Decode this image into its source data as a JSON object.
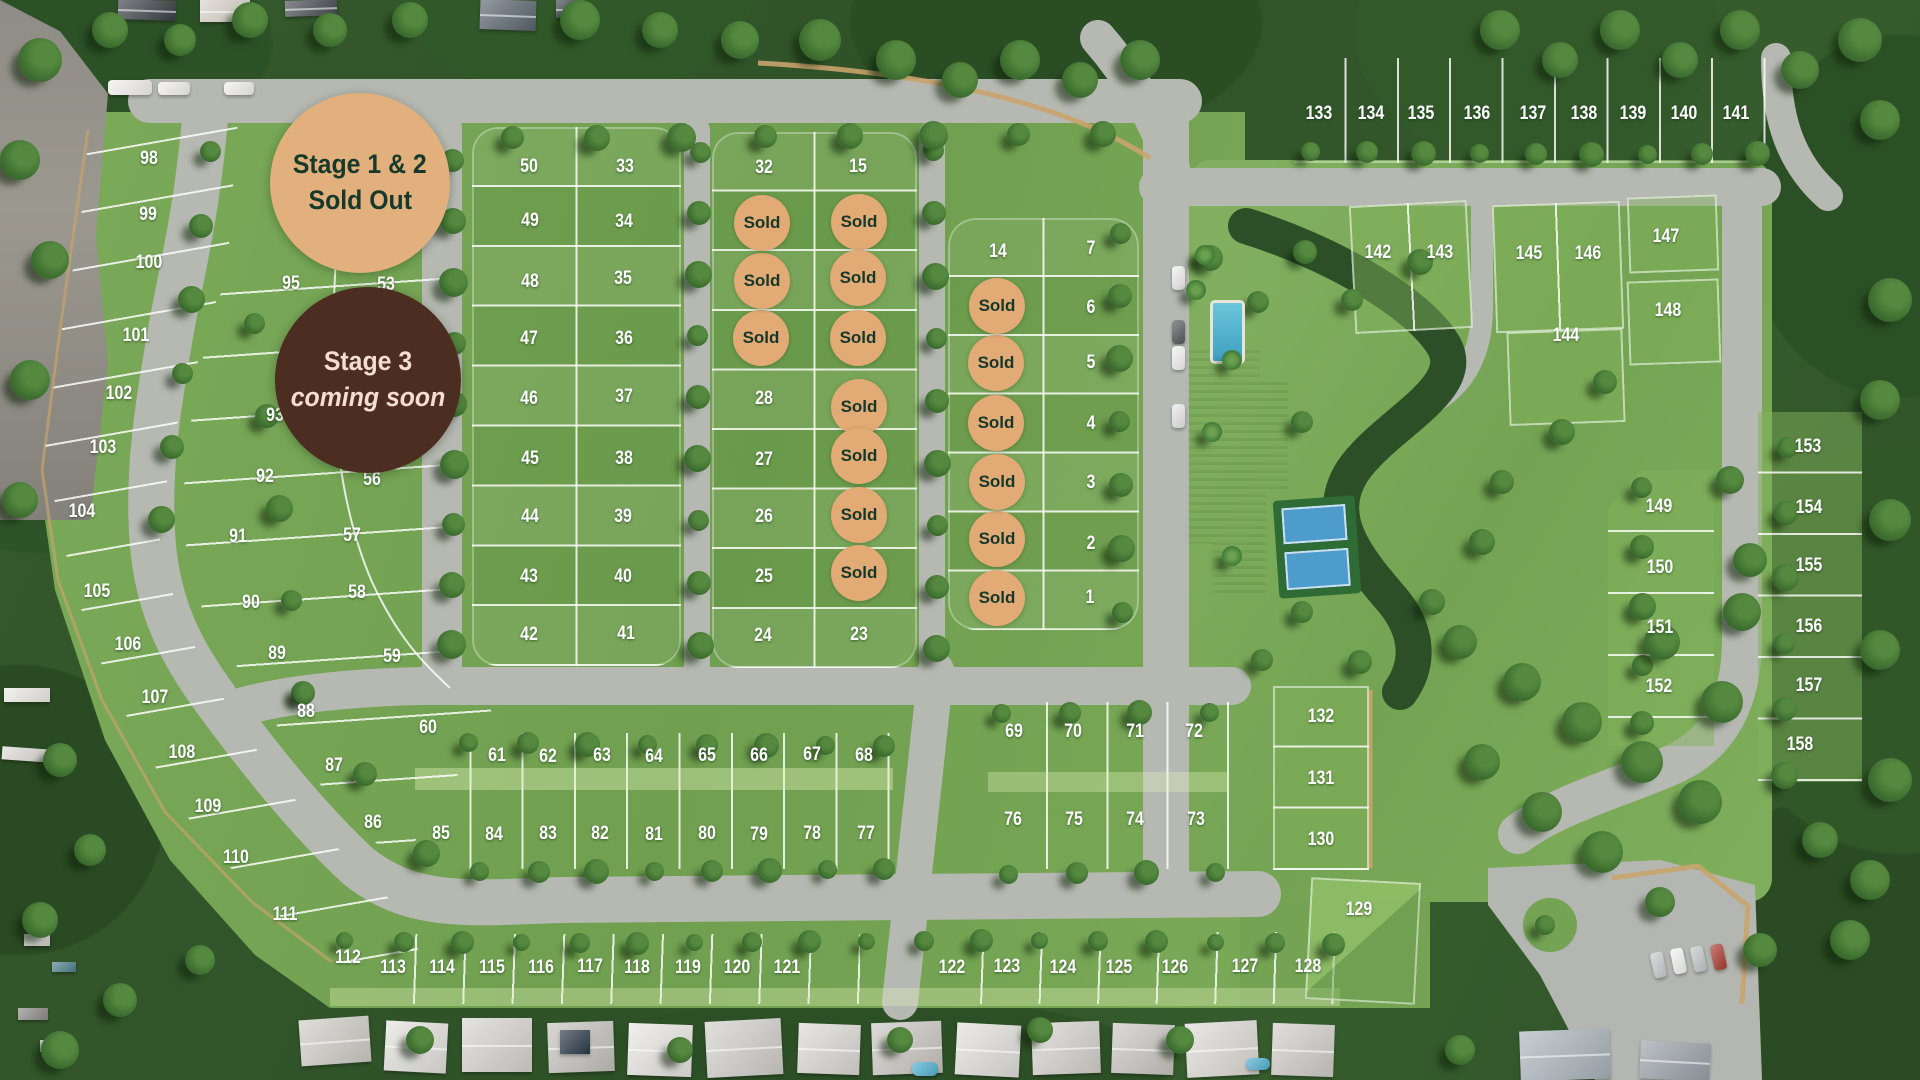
{
  "stage_badges": [
    {
      "id": "stage-1-2",
      "line1": "Stage 1 & 2",
      "line2": "Sold Out",
      "x": 360,
      "y": 183,
      "r": 90,
      "bg": "#e2b07d",
      "fg": "#17392b",
      "italic2": false
    },
    {
      "id": "stage-3",
      "line1": "Stage 3",
      "line2": "coming soon",
      "x": 368,
      "y": 380,
      "r": 93,
      "bg": "#4b2d21",
      "fg": "#f5ddd0",
      "italic2": true
    }
  ],
  "sold_label": "Sold",
  "colors": {
    "sold_bg": "#e2aa74",
    "sold_fg": "#15382b",
    "lot_text": "#ffffff",
    "road": "#b6b9b2",
    "lawn": "#74a354"
  },
  "lots": [
    {
      "n": 1,
      "x": 1090,
      "y": 598
    },
    {
      "n": 2,
      "x": 1091,
      "y": 544
    },
    {
      "n": 3,
      "x": 1091,
      "y": 483
    },
    {
      "n": 4,
      "x": 1091,
      "y": 424
    },
    {
      "n": 5,
      "x": 1091,
      "y": 363
    },
    {
      "n": 6,
      "x": 1091,
      "y": 308
    },
    {
      "n": 7,
      "x": 1091,
      "y": 249
    },
    {
      "n": 8,
      "x": 997,
      "y": 598,
      "sold": true
    },
    {
      "n": 9,
      "x": 997,
      "y": 539,
      "sold": true
    },
    {
      "n": 10,
      "x": 997,
      "y": 482,
      "sold": true
    },
    {
      "n": 11,
      "x": 996,
      "y": 423,
      "sold": true
    },
    {
      "n": 12,
      "x": 996,
      "y": 363,
      "sold": true
    },
    {
      "n": 13,
      "x": 997,
      "y": 306,
      "sold": true
    },
    {
      "n": 14,
      "x": 998,
      "y": 252
    },
    {
      "n": 15,
      "x": 858,
      "y": 167
    },
    {
      "n": 16,
      "x": 859,
      "y": 222,
      "sold": true
    },
    {
      "n": 17,
      "x": 858,
      "y": 278,
      "sold": true
    },
    {
      "n": 18,
      "x": 858,
      "y": 338,
      "sold": true
    },
    {
      "n": 19,
      "x": 859,
      "y": 407,
      "sold": true
    },
    {
      "n": 20,
      "x": 859,
      "y": 456,
      "sold": true
    },
    {
      "n": 21,
      "x": 859,
      "y": 515,
      "sold": true
    },
    {
      "n": 22,
      "x": 859,
      "y": 573,
      "sold": true
    },
    {
      "n": 23,
      "x": 859,
      "y": 635
    },
    {
      "n": 24,
      "x": 763,
      "y": 636
    },
    {
      "n": 25,
      "x": 764,
      "y": 577
    },
    {
      "n": 26,
      "x": 764,
      "y": 517
    },
    {
      "n": 27,
      "x": 764,
      "y": 460
    },
    {
      "n": 28,
      "x": 764,
      "y": 399
    },
    {
      "n": 29,
      "x": 761,
      "y": 338,
      "sold": true
    },
    {
      "n": 30,
      "x": 762,
      "y": 281,
      "sold": true
    },
    {
      "n": 31,
      "x": 762,
      "y": 223,
      "sold": true
    },
    {
      "n": 32,
      "x": 764,
      "y": 168
    },
    {
      "n": 33,
      "x": 625,
      "y": 167
    },
    {
      "n": 34,
      "x": 624,
      "y": 222
    },
    {
      "n": 35,
      "x": 623,
      "y": 279
    },
    {
      "n": 36,
      "x": 624,
      "y": 339
    },
    {
      "n": 37,
      "x": 624,
      "y": 397
    },
    {
      "n": 38,
      "x": 624,
      "y": 459
    },
    {
      "n": 39,
      "x": 623,
      "y": 517
    },
    {
      "n": 40,
      "x": 623,
      "y": 577
    },
    {
      "n": 41,
      "x": 626,
      "y": 634
    },
    {
      "n": 42,
      "x": 529,
      "y": 635
    },
    {
      "n": 43,
      "x": 529,
      "y": 577
    },
    {
      "n": 44,
      "x": 530,
      "y": 517
    },
    {
      "n": 45,
      "x": 530,
      "y": 459
    },
    {
      "n": 46,
      "x": 529,
      "y": 399
    },
    {
      "n": 47,
      "x": 529,
      "y": 339
    },
    {
      "n": 48,
      "x": 530,
      "y": 282
    },
    {
      "n": 49,
      "x": 530,
      "y": 221
    },
    {
      "n": 50,
      "x": 529,
      "y": 167
    },
    {
      "n": 53,
      "x": 386,
      "y": 285
    },
    {
      "n": 56,
      "x": 372,
      "y": 480
    },
    {
      "n": 57,
      "x": 352,
      "y": 536
    },
    {
      "n": 58,
      "x": 357,
      "y": 593
    },
    {
      "n": 59,
      "x": 392,
      "y": 657
    },
    {
      "n": 60,
      "x": 428,
      "y": 728
    },
    {
      "n": 61,
      "x": 497,
      "y": 756
    },
    {
      "n": 62,
      "x": 548,
      "y": 757
    },
    {
      "n": 63,
      "x": 602,
      "y": 756
    },
    {
      "n": 64,
      "x": 654,
      "y": 757
    },
    {
      "n": 65,
      "x": 707,
      "y": 756
    },
    {
      "n": 66,
      "x": 759,
      "y": 756
    },
    {
      "n": 67,
      "x": 812,
      "y": 755
    },
    {
      "n": 68,
      "x": 864,
      "y": 756
    },
    {
      "n": 69,
      "x": 1014,
      "y": 732
    },
    {
      "n": 70,
      "x": 1073,
      "y": 732
    },
    {
      "n": 71,
      "x": 1135,
      "y": 732
    },
    {
      "n": 72,
      "x": 1194,
      "y": 732
    },
    {
      "n": 73,
      "x": 1196,
      "y": 820
    },
    {
      "n": 74,
      "x": 1135,
      "y": 820
    },
    {
      "n": 75,
      "x": 1074,
      "y": 820
    },
    {
      "n": 76,
      "x": 1013,
      "y": 820
    },
    {
      "n": 77,
      "x": 866,
      "y": 834
    },
    {
      "n": 78,
      "x": 812,
      "y": 834
    },
    {
      "n": 79,
      "x": 759,
      "y": 835
    },
    {
      "n": 80,
      "x": 707,
      "y": 834
    },
    {
      "n": 81,
      "x": 654,
      "y": 835
    },
    {
      "n": 82,
      "x": 600,
      "y": 834
    },
    {
      "n": 83,
      "x": 548,
      "y": 834
    },
    {
      "n": 84,
      "x": 494,
      "y": 835
    },
    {
      "n": 85,
      "x": 441,
      "y": 834
    },
    {
      "n": 86,
      "x": 373,
      "y": 823
    },
    {
      "n": 87,
      "x": 334,
      "y": 766
    },
    {
      "n": 88,
      "x": 306,
      "y": 712
    },
    {
      "n": 89,
      "x": 277,
      "y": 654
    },
    {
      "n": 90,
      "x": 251,
      "y": 603
    },
    {
      "n": 91,
      "x": 238,
      "y": 537
    },
    {
      "n": 92,
      "x": 265,
      "y": 477
    },
    {
      "n": 93,
      "x": 275,
      "y": 416
    },
    {
      "n": 95,
      "x": 291,
      "y": 284
    },
    {
      "n": 98,
      "x": 149,
      "y": 159
    },
    {
      "n": 99,
      "x": 148,
      "y": 215
    },
    {
      "n": 100,
      "x": 149,
      "y": 263
    },
    {
      "n": 101,
      "x": 136,
      "y": 336
    },
    {
      "n": 102,
      "x": 119,
      "y": 394
    },
    {
      "n": 103,
      "x": 103,
      "y": 448
    },
    {
      "n": 104,
      "x": 82,
      "y": 512
    },
    {
      "n": 105,
      "x": 97,
      "y": 592
    },
    {
      "n": 106,
      "x": 128,
      "y": 645
    },
    {
      "n": 107,
      "x": 155,
      "y": 698
    },
    {
      "n": 108,
      "x": 182,
      "y": 753
    },
    {
      "n": 109,
      "x": 208,
      "y": 807
    },
    {
      "n": 110,
      "x": 236,
      "y": 858
    },
    {
      "n": 111,
      "x": 285,
      "y": 915
    },
    {
      "n": 112,
      "x": 348,
      "y": 958
    },
    {
      "n": 113,
      "x": 393,
      "y": 968
    },
    {
      "n": 114,
      "x": 442,
      "y": 968
    },
    {
      "n": 115,
      "x": 492,
      "y": 968
    },
    {
      "n": 116,
      "x": 541,
      "y": 968
    },
    {
      "n": 117,
      "x": 590,
      "y": 967
    },
    {
      "n": 118,
      "x": 637,
      "y": 968
    },
    {
      "n": 119,
      "x": 688,
      "y": 968
    },
    {
      "n": 120,
      "x": 737,
      "y": 968
    },
    {
      "n": 121,
      "x": 787,
      "y": 968
    },
    {
      "n": 122,
      "x": 952,
      "y": 968
    },
    {
      "n": 123,
      "x": 1007,
      "y": 967
    },
    {
      "n": 124,
      "x": 1063,
      "y": 968
    },
    {
      "n": 125,
      "x": 1119,
      "y": 968
    },
    {
      "n": 126,
      "x": 1175,
      "y": 968
    },
    {
      "n": 127,
      "x": 1245,
      "y": 967
    },
    {
      "n": 128,
      "x": 1308,
      "y": 967
    },
    {
      "n": 129,
      "x": 1359,
      "y": 910
    },
    {
      "n": 130,
      "x": 1321,
      "y": 840
    },
    {
      "n": 131,
      "x": 1321,
      "y": 779
    },
    {
      "n": 132,
      "x": 1321,
      "y": 717
    },
    {
      "n": 133,
      "x": 1319,
      "y": 114
    },
    {
      "n": 134,
      "x": 1371,
      "y": 114
    },
    {
      "n": 135,
      "x": 1421,
      "y": 114
    },
    {
      "n": 136,
      "x": 1477,
      "y": 114
    },
    {
      "n": 137,
      "x": 1533,
      "y": 114
    },
    {
      "n": 138,
      "x": 1584,
      "y": 114
    },
    {
      "n": 139,
      "x": 1633,
      "y": 114
    },
    {
      "n": 140,
      "x": 1684,
      "y": 114
    },
    {
      "n": 141,
      "x": 1736,
      "y": 114
    },
    {
      "n": 142,
      "x": 1378,
      "y": 253
    },
    {
      "n": 143,
      "x": 1440,
      "y": 253
    },
    {
      "n": 144,
      "x": 1566,
      "y": 336
    },
    {
      "n": 145,
      "x": 1529,
      "y": 254
    },
    {
      "n": 146,
      "x": 1588,
      "y": 254
    },
    {
      "n": 147,
      "x": 1666,
      "y": 237
    },
    {
      "n": 148,
      "x": 1668,
      "y": 311
    },
    {
      "n": 149,
      "x": 1659,
      "y": 507
    },
    {
      "n": 150,
      "x": 1660,
      "y": 568
    },
    {
      "n": 151,
      "x": 1660,
      "y": 628
    },
    {
      "n": 152,
      "x": 1659,
      "y": 687
    },
    {
      "n": 153,
      "x": 1808,
      "y": 447
    },
    {
      "n": 154,
      "x": 1809,
      "y": 508
    },
    {
      "n": 155,
      "x": 1809,
      "y": 566
    },
    {
      "n": 156,
      "x": 1809,
      "y": 627
    },
    {
      "n": 157,
      "x": 1809,
      "y": 686
    },
    {
      "n": 158,
      "x": 1800,
      "y": 745
    }
  ]
}
